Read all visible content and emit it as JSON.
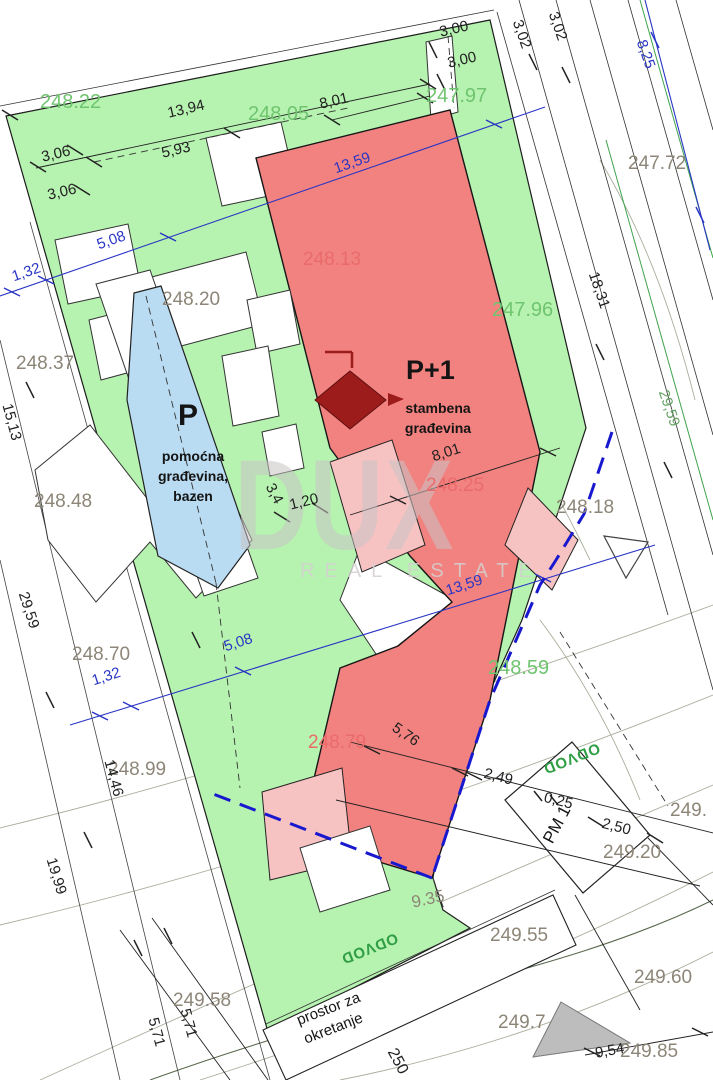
{
  "watermark": {
    "brand": "DUX",
    "tagline": "REAL ESTATE"
  },
  "areas": {
    "main_building": {
      "label": "P+1",
      "desc1": "stambena",
      "desc2": "građevina"
    },
    "aux_building": {
      "label": "P",
      "desc1": "pomoćna",
      "desc2": "građevina,",
      "desc3": "bazen"
    },
    "parking": {
      "label": "PM 1"
    },
    "turning": {
      "line1": "prostor za",
      "line2": "okretanje"
    },
    "drain": "ODVOD"
  },
  "elevations": {
    "e24822": "248.22",
    "e24805": "248.05",
    "e24797": "247.97",
    "e24796": "247.96",
    "e24859": "248.59",
    "t24772": "247.72",
    "t24837": "248.37",
    "t24848": "248.48",
    "t24820": "248.20",
    "t24870": "248.70",
    "t24899": "248.99",
    "t24818": "248.18",
    "t24920": "249.20",
    "t24955": "249.55",
    "t24960": "249.60",
    "t24958": "249.58",
    "t2497": "249.7",
    "t24985": "249.85",
    "t249x": "249.",
    "t935": "9.35",
    "b24813": "248.13",
    "b24825": "248.25",
    "b24879": "248.79"
  },
  "dimensions": {
    "blue": {
      "d132": "1,32",
      "d508": "5,08",
      "d1359": "13,59",
      "d825": "8,25"
    },
    "black": {
      "d1394": "13,94",
      "d593": "5,93",
      "d306": "3,06",
      "d300": "3,00",
      "d302": "3,02",
      "d801": "8,01",
      "d1831": "18,31",
      "d2959": "29,59",
      "d1513": "15,13",
      "d1446": "14,46",
      "d1999": "19,99",
      "d571": "5,71",
      "d576": "5,76",
      "d249": "2,49",
      "d025": "0,25",
      "d250": "2,50",
      "d954": "9,54",
      "d34": "3,4",
      "d120": "1,20"
    },
    "contour": {
      "c250": "250"
    }
  },
  "colors": {
    "plot_green": "#b6f2b0",
    "building_red": "#f2827f",
    "terrace_pink": "#f7c2c2",
    "pool_blue": "#b9dcf2",
    "boundary_blue": "#1818cf",
    "marker_dark_red": "#9c1c1c"
  }
}
